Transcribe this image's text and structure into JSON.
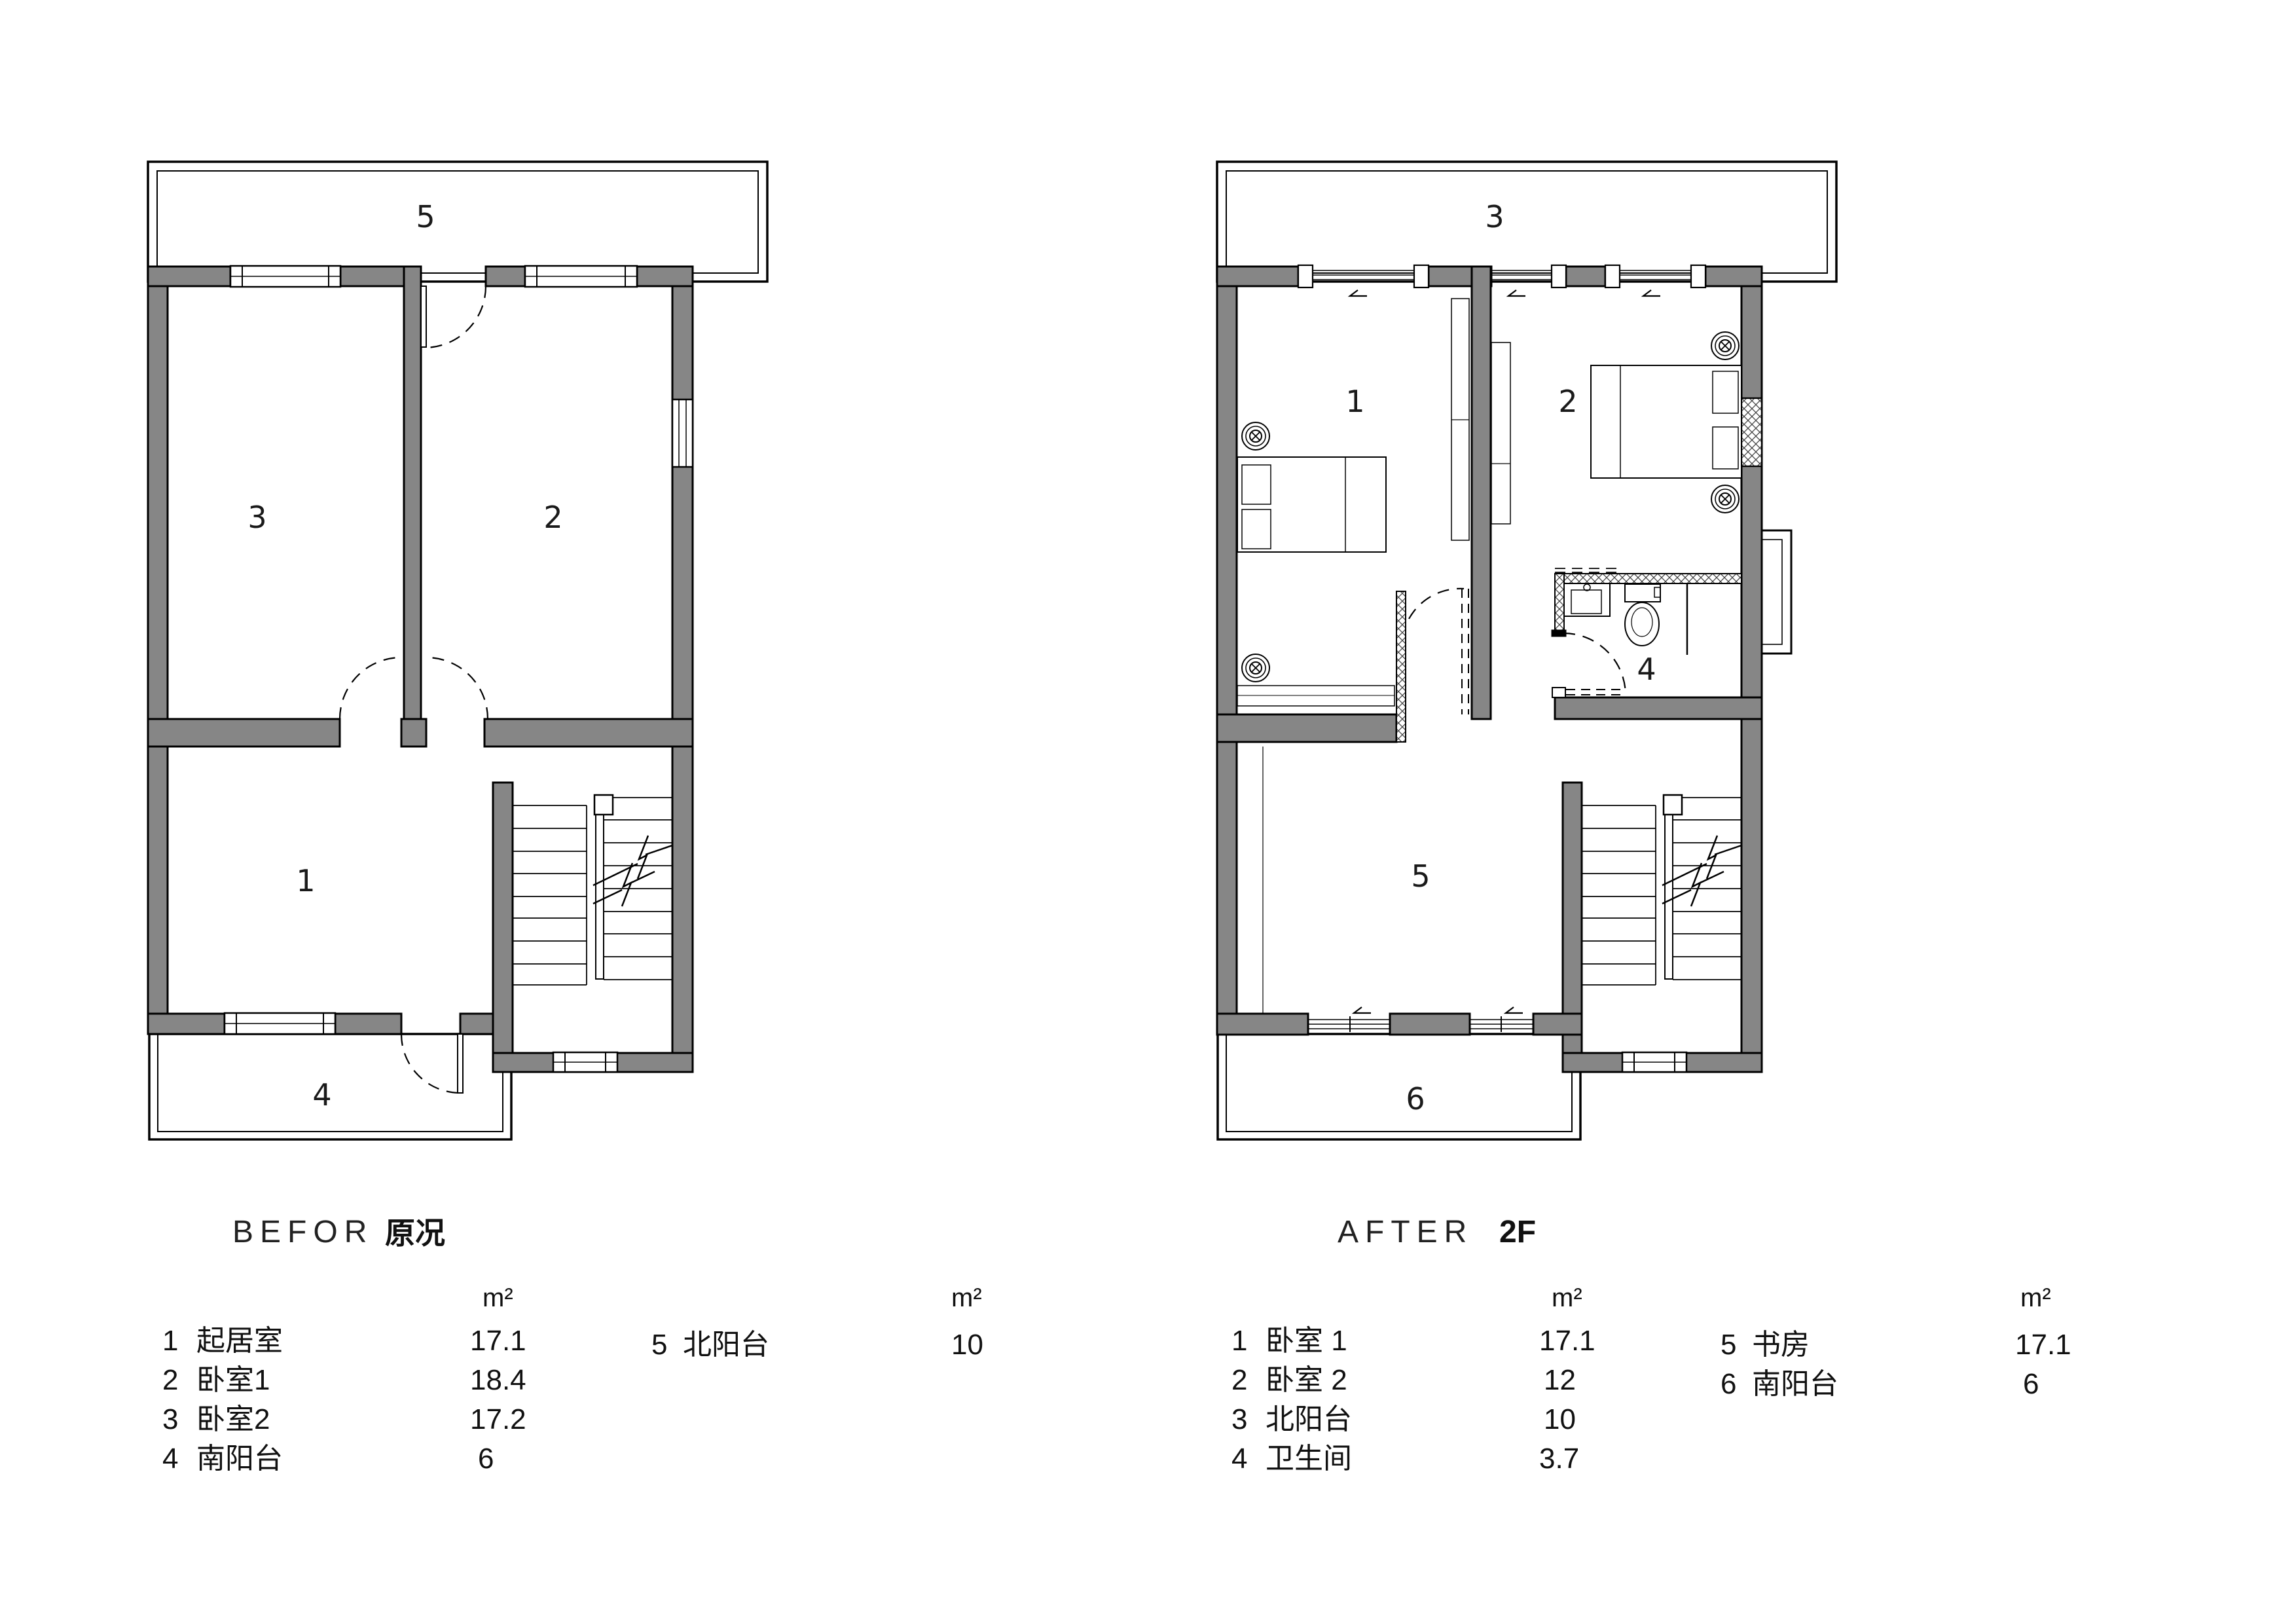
{
  "colors": {
    "wall_gray": "#868686",
    "line_black": "#000000",
    "background": "#ffffff"
  },
  "before": {
    "title_en": "BEFOR",
    "title_cn": "原况",
    "rooms": {
      "living": "1",
      "bedroom1": "2",
      "bedroom2": "3",
      "south_balcony": "4",
      "north_balcony": "5"
    },
    "legend": {
      "unit": "m²",
      "col1": [
        {
          "num": "1",
          "name": "起居室",
          "area": "17.1"
        },
        {
          "num": "2",
          "name": "卧室1",
          "area": "18.4"
        },
        {
          "num": "3",
          "name": "卧室2",
          "area": "17.2"
        },
        {
          "num": "4",
          "name": "南阳台",
          "area": "6"
        }
      ],
      "col2": [
        {
          "num": "5",
          "name": "北阳台",
          "area": "10"
        }
      ]
    }
  },
  "after": {
    "title_en": "AFTER",
    "title_floor": "2F",
    "rooms": {
      "bedroom1": "1",
      "bedroom2": "2",
      "north_balcony": "3",
      "bathroom": "4",
      "study": "5",
      "south_balcony": "6"
    },
    "legend": {
      "unit": "m²",
      "col1": [
        {
          "num": "1",
          "name": "卧室 1",
          "area": "17.1"
        },
        {
          "num": "2",
          "name": "卧室 2",
          "area": "12"
        },
        {
          "num": "3",
          "name": "北阳台",
          "area": "10"
        },
        {
          "num": "4",
          "name": "卫生间",
          "area": "3.7"
        }
      ],
      "col2": [
        {
          "num": "5",
          "name": "书房",
          "area": "17.1"
        },
        {
          "num": "6",
          "name": "南阳台",
          "area": "6"
        }
      ]
    }
  }
}
